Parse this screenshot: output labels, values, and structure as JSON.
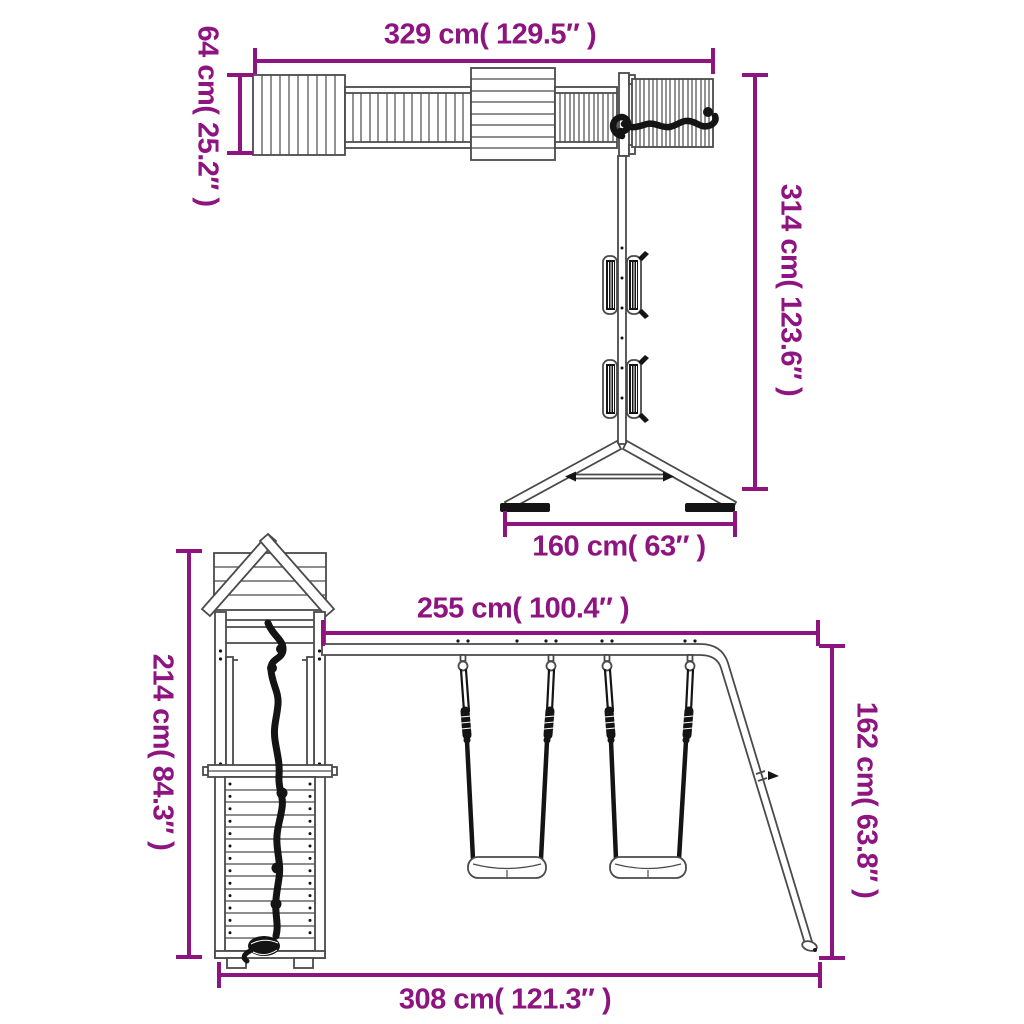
{
  "colors": {
    "dimension": "#8E1480",
    "line": "#4a4a4a",
    "dark": "#141414"
  },
  "top_diagram": {
    "name": "monkey-bar-bridge-with-swing-pole",
    "dimensions": {
      "total_width": "329 cm( 129.5″ )",
      "bridge_height": "64 cm( 25.2″ )",
      "total_height": "314 cm( 123.6″ )",
      "base_width": "160 cm( 63″ )"
    }
  },
  "bottom_diagram": {
    "name": "playhouse-tower-with-double-swing",
    "dimensions": {
      "beam_width": "255 cm( 100.4″ )",
      "tower_height": "214 cm( 84.3″ )",
      "swing_frame_height": "162 cm( 63.8″ )",
      "base_width": "308 cm( 121.3″ )"
    }
  }
}
